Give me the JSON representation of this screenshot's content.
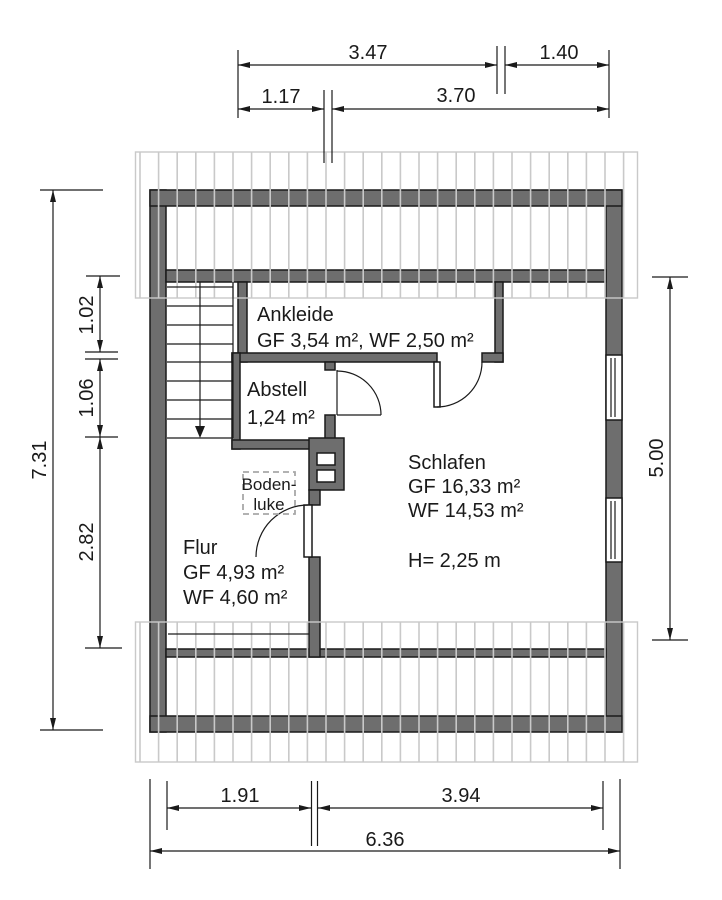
{
  "rooms": {
    "ankleide": {
      "name": "Ankleide",
      "areas": "GF 3,54 m², WF 2,50 m²"
    },
    "abstell": {
      "name": "Abstell",
      "areas": "1,24 m²"
    },
    "schlafen": {
      "name": "Schlafen",
      "gf": "GF 16,33 m²",
      "wf": "WF 14,53 m²",
      "height": "H= 2,25 m"
    },
    "flur": {
      "name": "Flur",
      "gf": "GF 4,93 m²",
      "wf": "WF 4,60 m²"
    },
    "bodenluke": {
      "line1": "Boden-",
      "line2": "luke"
    }
  },
  "dimensions": {
    "top": {
      "left_chain": "3.47",
      "right_chain": "1.40",
      "stair_chain": "1.17",
      "schlafen_chain": "3.70"
    },
    "left": {
      "total": "7.31",
      "ankleide": "1.02",
      "abstell": "1.06",
      "flur": "2.82"
    },
    "right": {
      "schlafen": "5.00"
    },
    "bottom": {
      "flur": "1.91",
      "schlafen": "3.94",
      "total": "6.36"
    }
  },
  "colors": {
    "wall": "#6e6e6e",
    "hatch": "#c9c9c9",
    "line": "#1a1a1a",
    "muted": "#a8a8a8"
  }
}
